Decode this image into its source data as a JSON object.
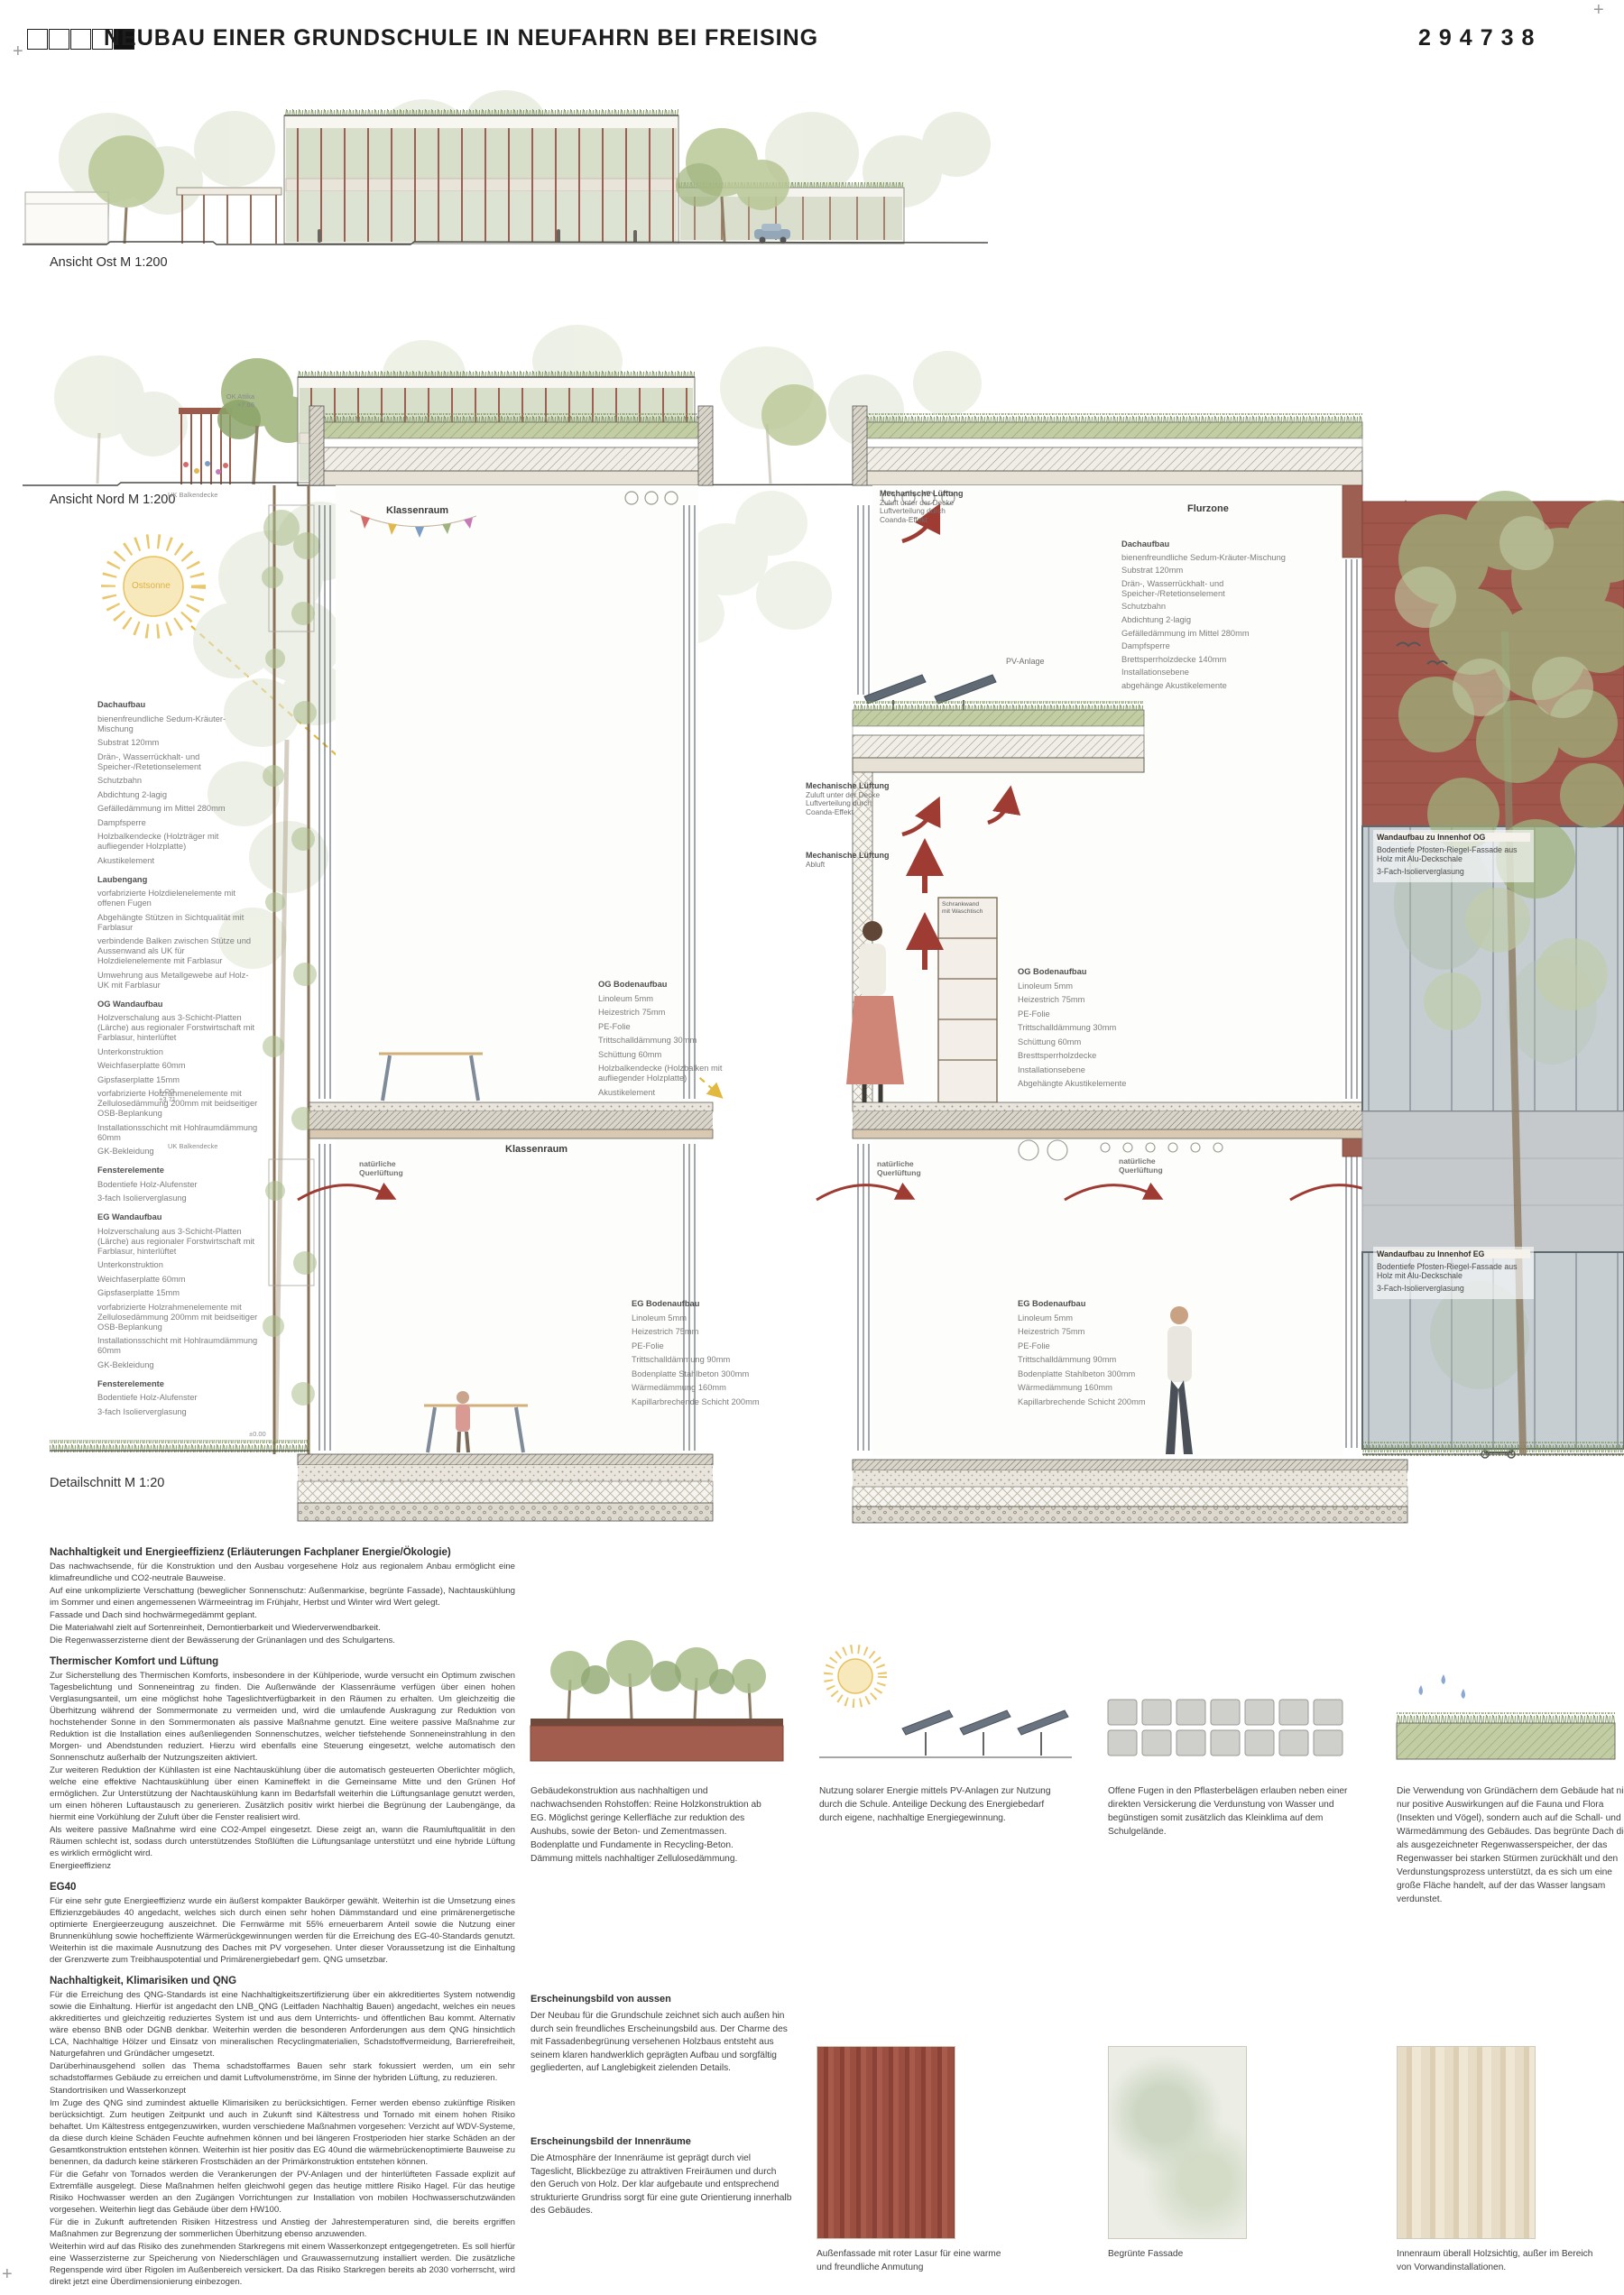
{
  "header": {
    "title": "NEUBAU EINER GRUNDSCHULE IN NEUFAHRN BEI FREISING",
    "code": "294738"
  },
  "captions": {
    "ansicht_ost": "Ansicht Ost M 1:200",
    "ansicht_nord": "Ansicht Nord M 1:200",
    "detailschnitt": "Detailschnitt M 1:20"
  },
  "sun": {
    "label": "Ostsonne"
  },
  "left_specs": [
    {
      "b": 1,
      "t": "Dachaufbau"
    },
    {
      "t": "bienenfreundliche Sedum-Kräuter-Mischung"
    },
    {
      "t": "Substrat 120mm"
    },
    {
      "t": "Drän-, Wasserrückhalt- und Speicher-/Retetionselement"
    },
    {
      "t": "Schutzbahn"
    },
    {
      "t": "Abdichtung 2-lagig"
    },
    {
      "t": "Gefälledämmung im Mittel 280mm"
    },
    {
      "t": "Dampfsperre"
    },
    {
      "t": "Holzbalkendecke (Holzträger mit aufliegender Holzplatte)"
    },
    {
      "t": "Akustikelement"
    },
    {
      "b": 1,
      "t": "Laubengang"
    },
    {
      "t": "vorfabrizierte Holzdielenelemente mit offenen Fugen"
    },
    {
      "t": "Abgehängte Stützen in Sichtqualität mit Farblasur"
    },
    {
      "t": "verbindende Balken zwischen Stütze und Aussenwand als UK für Holzdielenelemente mit Farblasur"
    },
    {
      "t": "Umwehrung aus Metallgewebe auf Holz-UK mit Farblasur"
    },
    {
      "b": 1,
      "t": "OG Wandaufbau"
    },
    {
      "t": "Holzverschalung aus 3-Schicht-Platten (Lärche) aus regionaler Forstwirtschaft mit Farblasur, hinterlüftet"
    },
    {
      "t": "Unterkonstruktion"
    },
    {
      "t": "Weichfaserplatte 60mm"
    },
    {
      "t": "Gipsfaserplatte 15mm"
    },
    {
      "t": "vorfabrizierte Holzrahmenelemente mit Zellulosedämmung 200mm mit beidseitiger OSB-Beplankung"
    },
    {
      "t": "Installationsschicht mit Hohlraumdämmung 60mm"
    },
    {
      "t": "GK-Bekleidung"
    },
    {
      "b": 1,
      "t": "Fensterelemente"
    },
    {
      "t": "Bodentiefe Holz-Alufenster"
    },
    {
      "t": "3-fach Isolierverglasung"
    },
    {
      "b": 1,
      "t": "EG Wandaufbau"
    },
    {
      "t": "Holzverschalung aus 3-Schicht-Platten (Lärche) aus regionaler Forstwirtschaft mit Farblasur, hinterlüftet"
    },
    {
      "t": "Unterkonstruktion"
    },
    {
      "t": "Weichfaserplatte 60mm"
    },
    {
      "t": "Gipsfaserplatte 15mm"
    },
    {
      "t": "vorfabrizierte Holzrahmenelemente mit Zellulosedämmung 200mm mit beidseitiger OSB-Beplankung"
    },
    {
      "t": "Installationsschicht mit Hohlraumdämmung 60mm"
    },
    {
      "t": "GK-Bekleidung"
    },
    {
      "b": 1,
      "t": "Fensterelemente"
    },
    {
      "t": "Bodentiefe Holz-Alufenster"
    },
    {
      "t": "3-fach Isolierverglasung"
    }
  ],
  "right_roof_specs": [
    {
      "b": 1,
      "t": "Dachaufbau"
    },
    {
      "t": "bienenfreundliche Sedum-Kräuter-Mischung"
    },
    {
      "t": "Substrat 120mm"
    },
    {
      "t": "Drän-, Wasserrückhalt- und Speicher-/Retetionselement"
    },
    {
      "t": "Schutzbahn"
    },
    {
      "t": "Abdichtung 2-lagig"
    },
    {
      "t": "Gefälledämmung im Mittel 280mm"
    },
    {
      "t": "Dampfsperre"
    },
    {
      "t": "Brettsperrholzdecke 140mm"
    },
    {
      "t": "Installationsebene"
    },
    {
      "t": "abgehänge Akustikelemente"
    }
  ],
  "og_boden_left": [
    {
      "b": 1,
      "t": "OG Bodenaufbau"
    },
    {
      "t": "Linoleum 5mm"
    },
    {
      "t": "Heizestrich 75mm"
    },
    {
      "t": "PE-Folie"
    },
    {
      "t": "Trittschalldämmung 30mm"
    },
    {
      "t": "Schüttung 60mm"
    },
    {
      "t": "Holzbalkendecke (Holzbalken mit aufliegender Holzplatte)"
    },
    {
      "t": "Akustikelement"
    }
  ],
  "og_boden_right": [
    {
      "b": 1,
      "t": "OG Bodenaufbau"
    },
    {
      "t": "Linoleum 5mm"
    },
    {
      "t": "Heizestrich 75mm"
    },
    {
      "t": "PE-Folie"
    },
    {
      "t": "Trittschalldämmung 30mm"
    },
    {
      "t": "Schüttung 60mm"
    },
    {
      "t": "Bresttsperrholzdecke"
    },
    {
      "t": "Installationsebene"
    },
    {
      "t": "Abgehängte Akustikelemente"
    }
  ],
  "eg_boden": [
    {
      "b": 1,
      "t": "EG Bodenaufbau"
    },
    {
      "t": "Linoleum 5mm"
    },
    {
      "t": "Heizestrich 75mm"
    },
    {
      "t": "PE-Folie"
    },
    {
      "t": "Trittschalldämmung 90mm"
    },
    {
      "t": "Bodenplatte Stahlbeton 300mm"
    },
    {
      "t": "Wärmedämmung 160mm"
    },
    {
      "t": "Kapillarbrechende Schicht 200mm"
    }
  ],
  "wand_og": [
    {
      "b": 1,
      "t": "Wandaufbau zu Innenhof OG"
    },
    {
      "t": "Bodentiefe Pfosten-Riegel-Fassade aus Holz mit Alu-Deckschale"
    },
    {
      "t": "3-Fach-Isolierverglasung"
    }
  ],
  "wand_eg": [
    {
      "b": 1,
      "t": "Wandaufbau zu Innenhof EG"
    },
    {
      "t": "Bodentiefe Pfosten-Riegel-Fassade aus Holz mit Alu-Deckschale"
    },
    {
      "t": "3-Fach-Isolierverglasung"
    }
  ],
  "section_labels": {
    "klassenraum_og": "Klassenraum",
    "klassenraum_eg": "Klassenraum",
    "flurzone": "Flurzone",
    "pv_anlage": "PV-Anlage",
    "schrankwand_l1": "Schrankwand",
    "schrankwand_l2": "mit Waschtisch",
    "quer_l1": "natürliche",
    "quer_l2": "Querlüftung",
    "mech_head": "Mechanische Lüftung",
    "zuluft_l1": "Zuluft unter der Decke",
    "zuluft_l2": "Luftverteilung durch",
    "zuluft_l3": "Coanda-Effekt",
    "abluft": "Abluft"
  },
  "levels": {
    "ok_attika_1": "OK Attika",
    "ok_attika_2": "+7.66",
    "uk_balkendecke": "UK Balkendecke",
    "og1_1": "1.OG",
    "og1_2": "+3.71",
    "eg_null": "±0.00"
  },
  "essay": [
    {
      "c": "eh",
      "t": "Nachhaltigkeit und Energieeffizienz  (Erläuterungen Fachplaner Energie/Ökologie)"
    },
    {
      "c": "ep",
      "t": "Das nachwachsende, für die Konstruktion und den Ausbau vorgesehene Holz aus regionalem Anbau ermöglicht eine klimafreundliche und CO2-neutrale Bauweise."
    },
    {
      "c": "ep",
      "t": "Auf eine unkomplizierte Verschattung (beweglicher Sonnenschutz: Außenmarkise, begrünte Fassade), Nachtauskühlung im Sommer und einen angemessenen Wärmeeintrag im Frühjahr, Herbst und Winter wird Wert gelegt."
    },
    {
      "c": "ep",
      "t": "Fassade und Dach sind hochwärmegedämmt geplant."
    },
    {
      "c": "ep",
      "t": "Die Materialwahl zielt auf Sortenreinheit, Demontierbarkeit und Wiederverwendbarkeit."
    },
    {
      "c": "ep",
      "t": "Die Regenwasserzisterne dient der Bewässerung der Grünanlagen und des Schulgartens."
    },
    {
      "c": "eh",
      "t": "Thermischer Komfort und Lüftung"
    },
    {
      "c": "ep",
      "t": "Zur Sicherstellung des Thermischen Komforts, insbesondere in der Kühlperiode, wurde versucht ein Optimum zwischen Tagesbelichtung und Sonneneintrag zu finden. Die Außenwände der Klassenräume verfügen über einen hohen Verglasungsanteil, um eine möglichst hohe Tageslichtverfügbarkeit in den Räumen zu erhalten. Um gleichzeitig die Überhitzung während der Sommermonate zu vermeiden und, wird die umlaufende Auskragung zur Reduktion von hochstehender Sonne in den Sommermonaten als passive Maßnahme genutzt. Eine weitere passive Maßnahme zur Reduktion ist die Installation eines außenliegenden Sonnenschutzes, welcher tiefstehende Sonneneinstrahlung in den Morgen- und Abendstunden reduziert. Hierzu wird ebenfalls eine Steuerung eingesetzt, welche automatisch den Sonnenschutz außerhalb der Nutzungszeiten aktiviert."
    },
    {
      "c": "ep",
      "t": "Zur weiteren Reduktion der Kühllasten ist eine Nachtauskühlung über die automatisch gesteuerten Oberlichter möglich, welche eine effektive Nachtauskühlung über einen Kamineffekt in die Gemeinsame Mitte und den Grünen Hof ermöglichen. Zur Unterstützung der Nachtauskühlung kann im Bedarfsfall weiterhin die Lüftungsanlage genutzt werden, um einen höheren Luftaustausch zu generieren. Zusätzlich positiv wirkt hierbei die Begrünung der Laubengänge, da hiermit eine Vorkühlung der Zuluft über die Fenster realisiert wird."
    },
    {
      "c": "ep",
      "t": "Als weitere passive Maßnahme wird eine CO2-Ampel eingesetzt. Diese zeigt an, wann die Raumluftqualität in den Räumen schlecht ist, sodass durch unterstützendes Stoßlüften die Lüftungsanlage unterstützt und eine hybride Lüftung es wirklich ermöglicht wird."
    },
    {
      "c": "ep",
      "t": "Energieeffizienz"
    },
    {
      "c": "eh",
      "t": "EG40"
    },
    {
      "c": "ep",
      "t": "Für eine sehr gute Energieeffizienz wurde ein äußerst kompakter Baukörper gewählt. Weiterhin ist die Umsetzung eines Effizienzgebäudes 40 angedacht, welches sich durch einen sehr hohen Dämmstandard und eine primärenergetische optimierte Energieerzeugung auszeichnet. Die Fernwärme mit 55% erneuerbarem Anteil sowie die Nutzung einer Brunnenkühlung sowie hocheffiziente Wärmerückgewinnungen werden für die Erreichung des EG-40-Standards genutzt. Weiterhin ist die maximale Ausnutzung des Daches mit PV vorgesehen. Unter dieser Voraussetzung ist die Einhaltung der Grenzwerte zum Treibhauspotential und Primärenergiebedarf gem. QNG umsetzbar."
    },
    {
      "c": "eh",
      "t": "Nachhaltigkeit, Klimarisiken und QNG"
    },
    {
      "c": "ep",
      "t": "Für die Erreichung des QNG-Standards ist eine Nachhaltigkeitszertifizierung über ein akkreditiertes System notwendig sowie die Einhaltung. Hierfür ist angedacht den LNB_QNG (Leitfaden Nachhaltig Bauen) angedacht, welches ein neues akkreditiertes und gleichzeitig reduziertes System ist und aus dem Unterrichts- und öffentlichen Bau kommt. Alternativ wäre ebenso BNB oder DGNB denkbar. Weiterhin werden die besonderen Anforderungen aus dem QNG hinsichtlich LCA, Nachhaltige Hölzer und Einsatz von mineralischen Recyclingmaterialien, Schadstoffvermeidung, Barrierefreiheit, Naturgefahren und Gründächer umgesetzt."
    },
    {
      "c": "ep",
      "t": "Darüberhinausgehend sollen das Thema schadstoffarmes Bauen sehr stark fokussiert werden, um ein sehr schadstoffarmes Gebäude zu erreichen und damit Luftvolumenströme, im Sinne der hybriden Lüftung, zu reduzieren."
    },
    {
      "c": "ep",
      "t": "Standortrisiken und Wasserkonzept"
    },
    {
      "c": "ep",
      "t": "Im Zuge des QNG sind zumindest aktuelle Klimarisiken zu berücksichtigen. Ferner werden ebenso zukünftige Risiken berücksichtigt. Zum heutigen Zeitpunkt und auch in Zukunft sind Kältestress und Tornado mit einem hohen Risiko behaftet. Um Kältestress entgegenzuwirken, wurden verschiedene Maßnahmen vorgesehen: Verzicht auf WDV-Systeme, da diese durch kleine Schäden Feuchte aufnehmen können und bei längeren Frostperioden hier starke Schäden an der Gesamtkonstruktion entstehen können. Weiterhin ist hier positiv das EG 40und die wärmebrückenoptimierte Bauweise zu benennen, da dadurch keine stärkeren Frostschäden an der Primärkonstruktion entstehen können."
    },
    {
      "c": "ep",
      "t": "Für die Gefahr von Tornados werden die Verankerungen der PV-Anlagen und der hinterlüfteten Fassade explizit auf Extremfälle ausgelegt. Diese Maßnahmen helfen gleichwohl gegen das heutige mittlere Risiko Hagel. Für das heutige Risiko Hochwasser werden an den Zugängen Vorrichtungen zur Installation von mobilen Hochwasserschutzwänden vorgesehen. Weiterhin liegt das Gebäude über dem HW100."
    },
    {
      "c": "ep",
      "t": "Für die in Zukunft auftretenden Risiken Hitzestress und Anstieg der Jahrestemperaturen sind, die bereits ergriffen Maßnahmen zur Begrenzung der sommerlichen Überhitzung ebenso anzuwenden."
    },
    {
      "c": "ep",
      "t": "Weiterhin wird auf das Risiko des zunehmenden Starkregens mit einem Wasserkonzept entgegengetreten. Es soll hierfür eine Wasserzisterne zur Speicherung von Niederschlägen und Grauwassernutzung installiert werden. Die zusätzliche Regenspende wird über Rigolen im Außenbereich versickert. Da das Risiko Starkregen bereits ab 2030 vorherrscht, wird direkt jetzt eine Überdimensionierung einbezogen."
    }
  ],
  "diagram_captions": {
    "d1": "Gebäudekonstruktion aus nachhaltigen und nachwachsenden Rohstoffen: Reine Holzkonstruktion ab EG. Möglichst geringe Kellerfläche zur reduktion des Aushubs, sowie der Beton- und Zementmassen. Bodenplatte und Fundamente in Recycling-Beton. Dämmung mittels nachhaltiger Zellulosedämmung.",
    "d2": "Nutzung solarer Energie mittels PV-Anlagen zur Nutzung durch die Schule. Anteilige Deckung des Energiebedarf durch eigene, nachhaltige Energiegewinnung.",
    "d3": "Offene Fugen in den Pflasterbelägen erlauben neben einer direkten Versickerung die Verdunstung von Wasser und begünstigen somit zusätzlich das Kleinklima auf dem Schulgelände.",
    "d4": "Die Verwendung von Gründächern dem Gebäude hat nicht nur positive Auswirkungen auf die Fauna und Flora (Insekten und Vögel), sondern auch auf die Schall- und Wärmedämmung des Gebäudes. Das begrünte Dach dient als ausgezeichneter Regenwasserspeicher, der das Regenwasser bei starken Stürmen zurückhält und den Verdunstungsprozess unterstützt, da es sich um eine große Fläche handelt, auf der das Wasser langsam verdunstet."
  },
  "erscheinung": {
    "h1": "Erscheinungsbild von aussen",
    "p1": "Der Neubau für die Grundschule zeichnet sich auch außen hin durch sein freundliches Erscheinungsbild aus. Der Charme des mit Fassadenbegrünung versehenen Holzbaus entsteht aus seinem klaren handwerklich geprägten Aufbau und sorgfältig gegliederten, auf Langlebigkeit zielenden Details.",
    "h2": "Erscheinungsbild der Innenräume",
    "p2": "Die Atmosphäre der Innenräume ist geprägt durch viel Tageslicht, Blickbezüge zu attraktiven Freiräumen und durch den Geruch von Holz. Der klar aufgebaute und entsprechend strukturierte Grundriss sorgt für eine gute Orientierung innerhalb des Gebäudes."
  },
  "swatch_captions": {
    "s1": "Außenfassade mit roter Lasur für eine warme und freundliche Anmutung",
    "s2": "Begrünte Fassade",
    "s3": "Innenraum überall Holzsichtig, außer im Bereich von Vorwandinstallationen."
  },
  "colors": {
    "accent_red": "#9d5f51",
    "arrow_red": "#9e3b32",
    "sun_yellow": "#e7c15c",
    "foliage_green": "#9fb37e"
  }
}
